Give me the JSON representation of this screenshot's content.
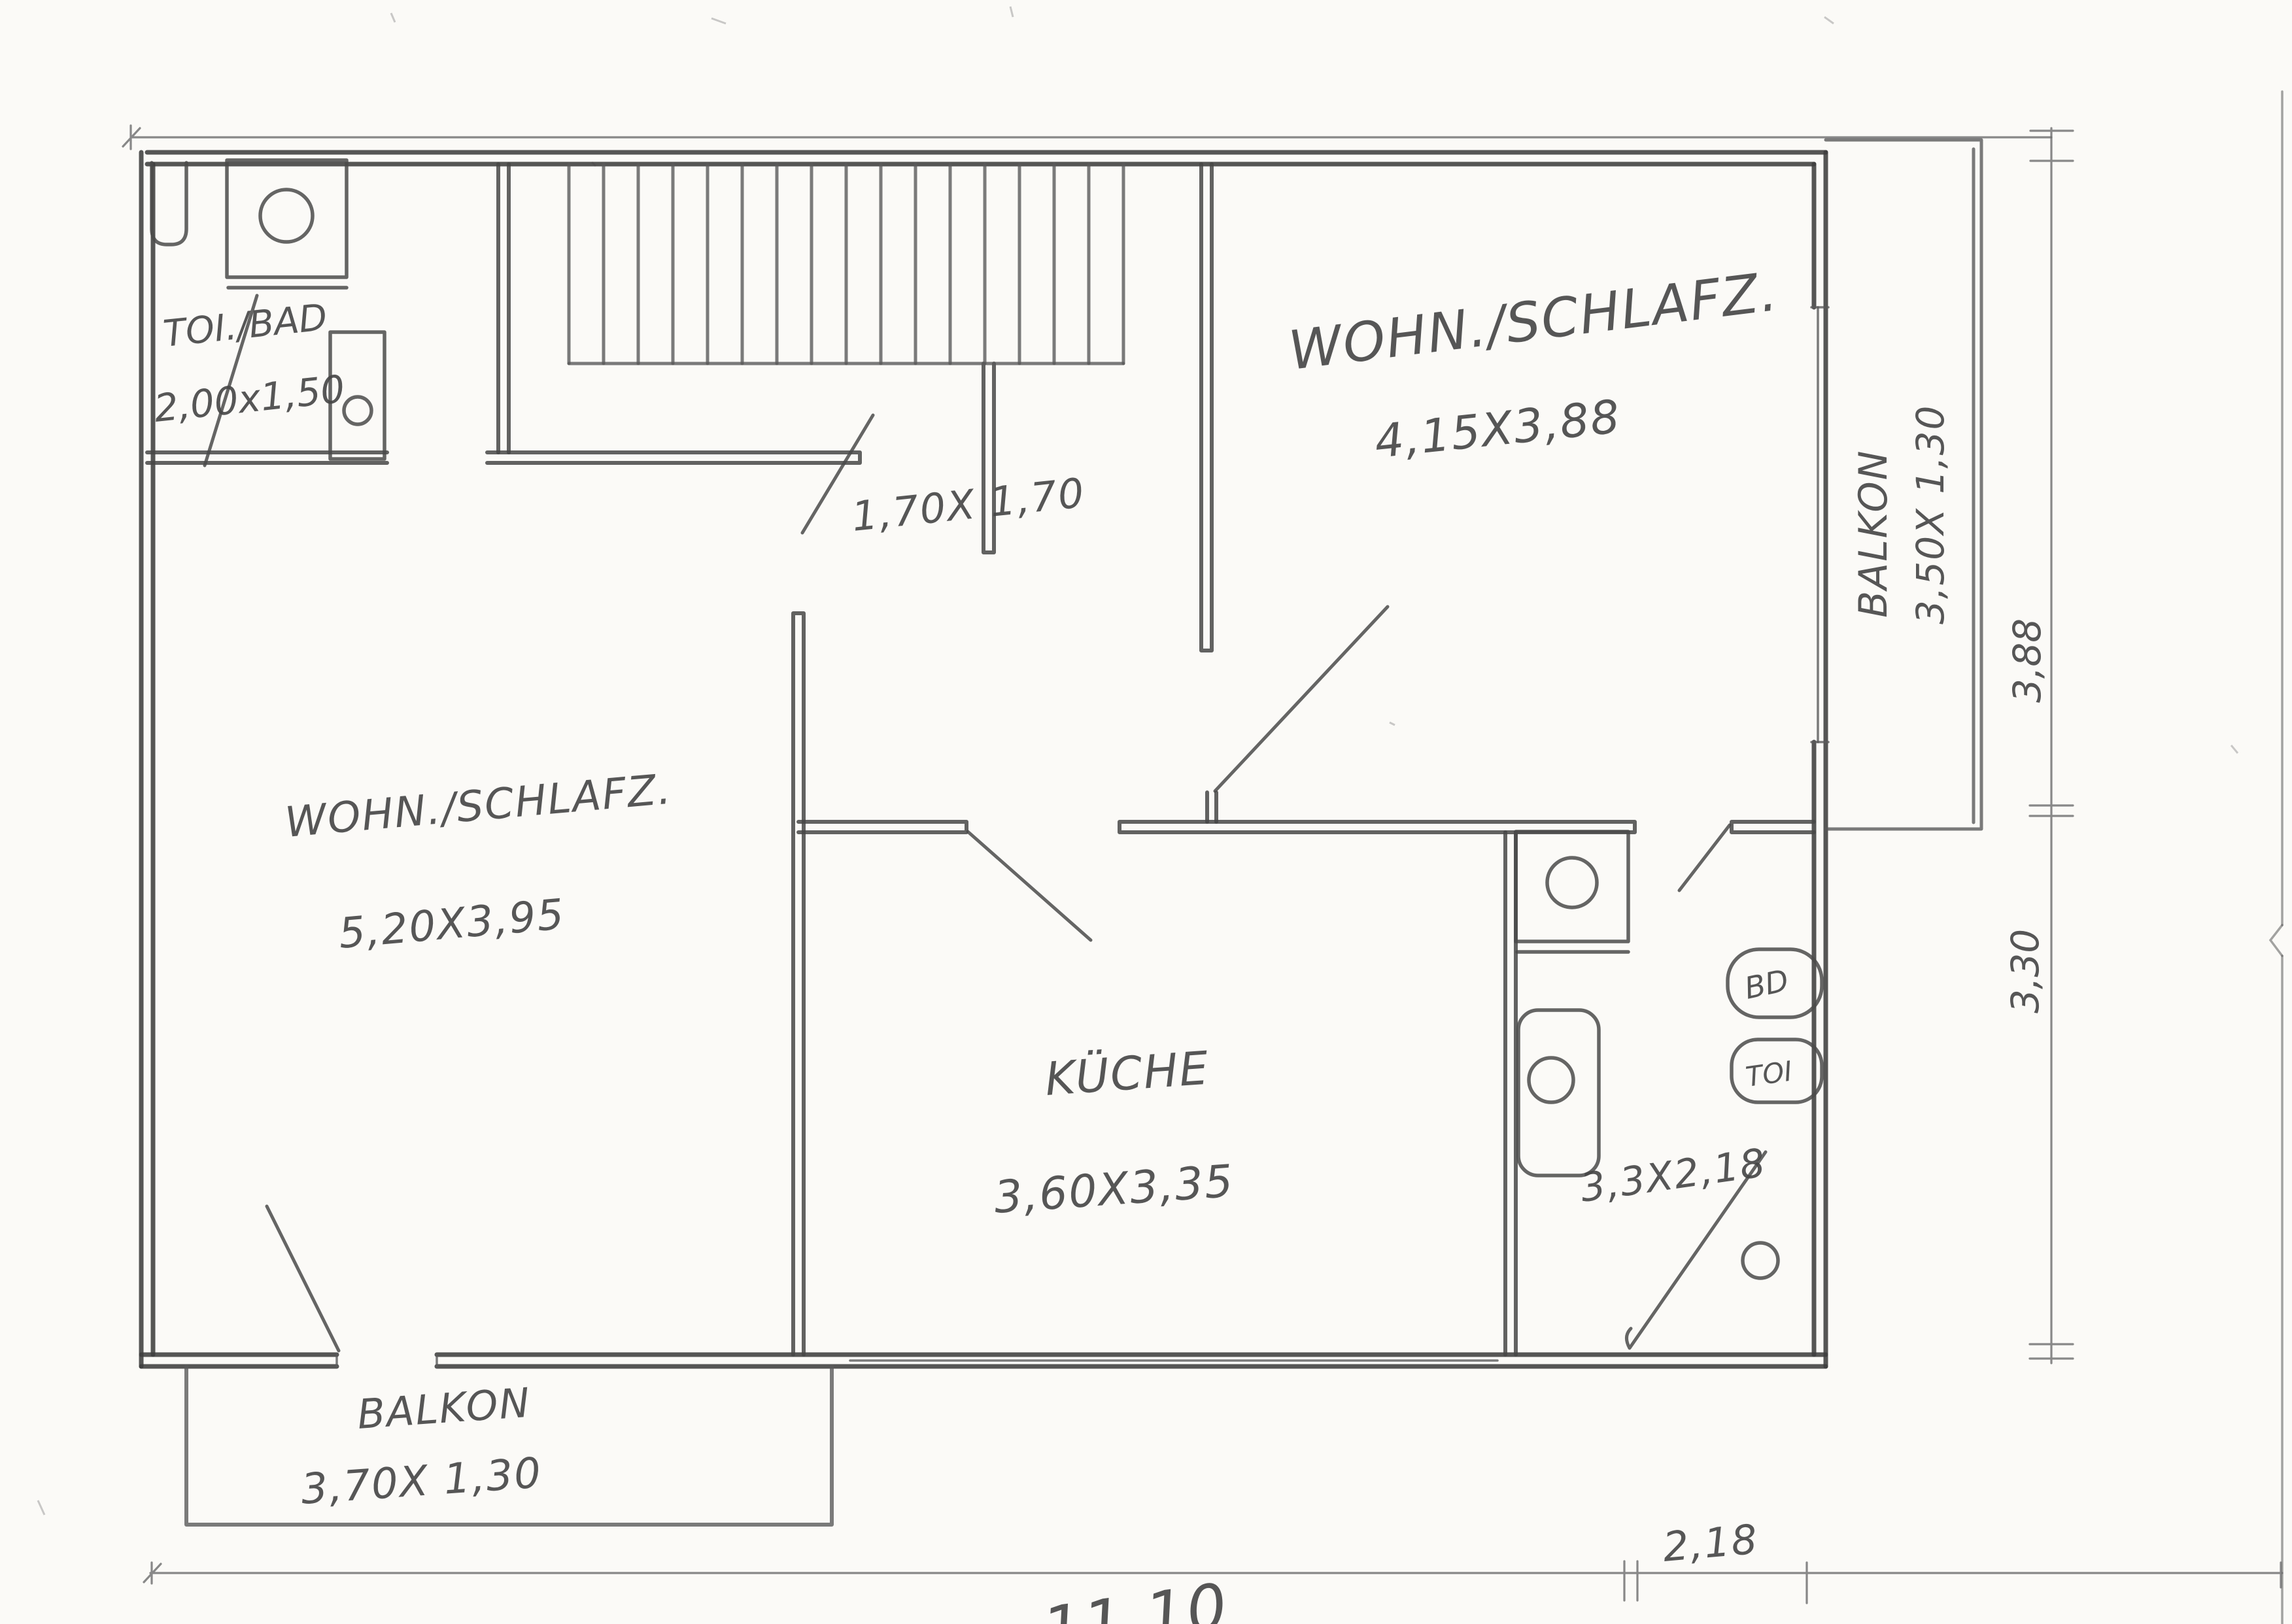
{
  "document": {
    "kind": "hand-drawn floor plan (pencil sketch, scanned)"
  },
  "rooms": {
    "bathroom_top_left": {
      "name": "TOI./BAD",
      "dimensions": "2,00x1,50"
    },
    "living_top_right": {
      "name": "WOHN./SCHLAFZ.",
      "dimensions": "4,15X3,88"
    },
    "living_left": {
      "name": "WOHN./SCHLAFZ.",
      "dimensions": "5,20X3,95"
    },
    "kitchen": {
      "name": "KÜCHE",
      "dimensions": "3,60X3,35"
    },
    "hall": {
      "dimensions": "1,70X 1,70"
    },
    "bathroom_right": {
      "dimensions": "3,3X2,18",
      "fixture_labels": {
        "bidet": "BD",
        "toilet": "TOI"
      }
    }
  },
  "balconies": {
    "right": {
      "name": "BALKON",
      "dimensions": "3,50X 1,30"
    },
    "bottom": {
      "name": "BALKON",
      "dimensions": "3,70X 1,30"
    }
  },
  "dimension_annotations": {
    "right_upper": "3,88",
    "right_lower": "3,30",
    "bottom_total": "11,10",
    "bottom_right": "2,18"
  },
  "colors": {
    "paper": "#fbfaf7",
    "pencil": "#4a4a4a",
    "pencil_dark": "#373737",
    "pencil_light": "#8a8a8a"
  }
}
